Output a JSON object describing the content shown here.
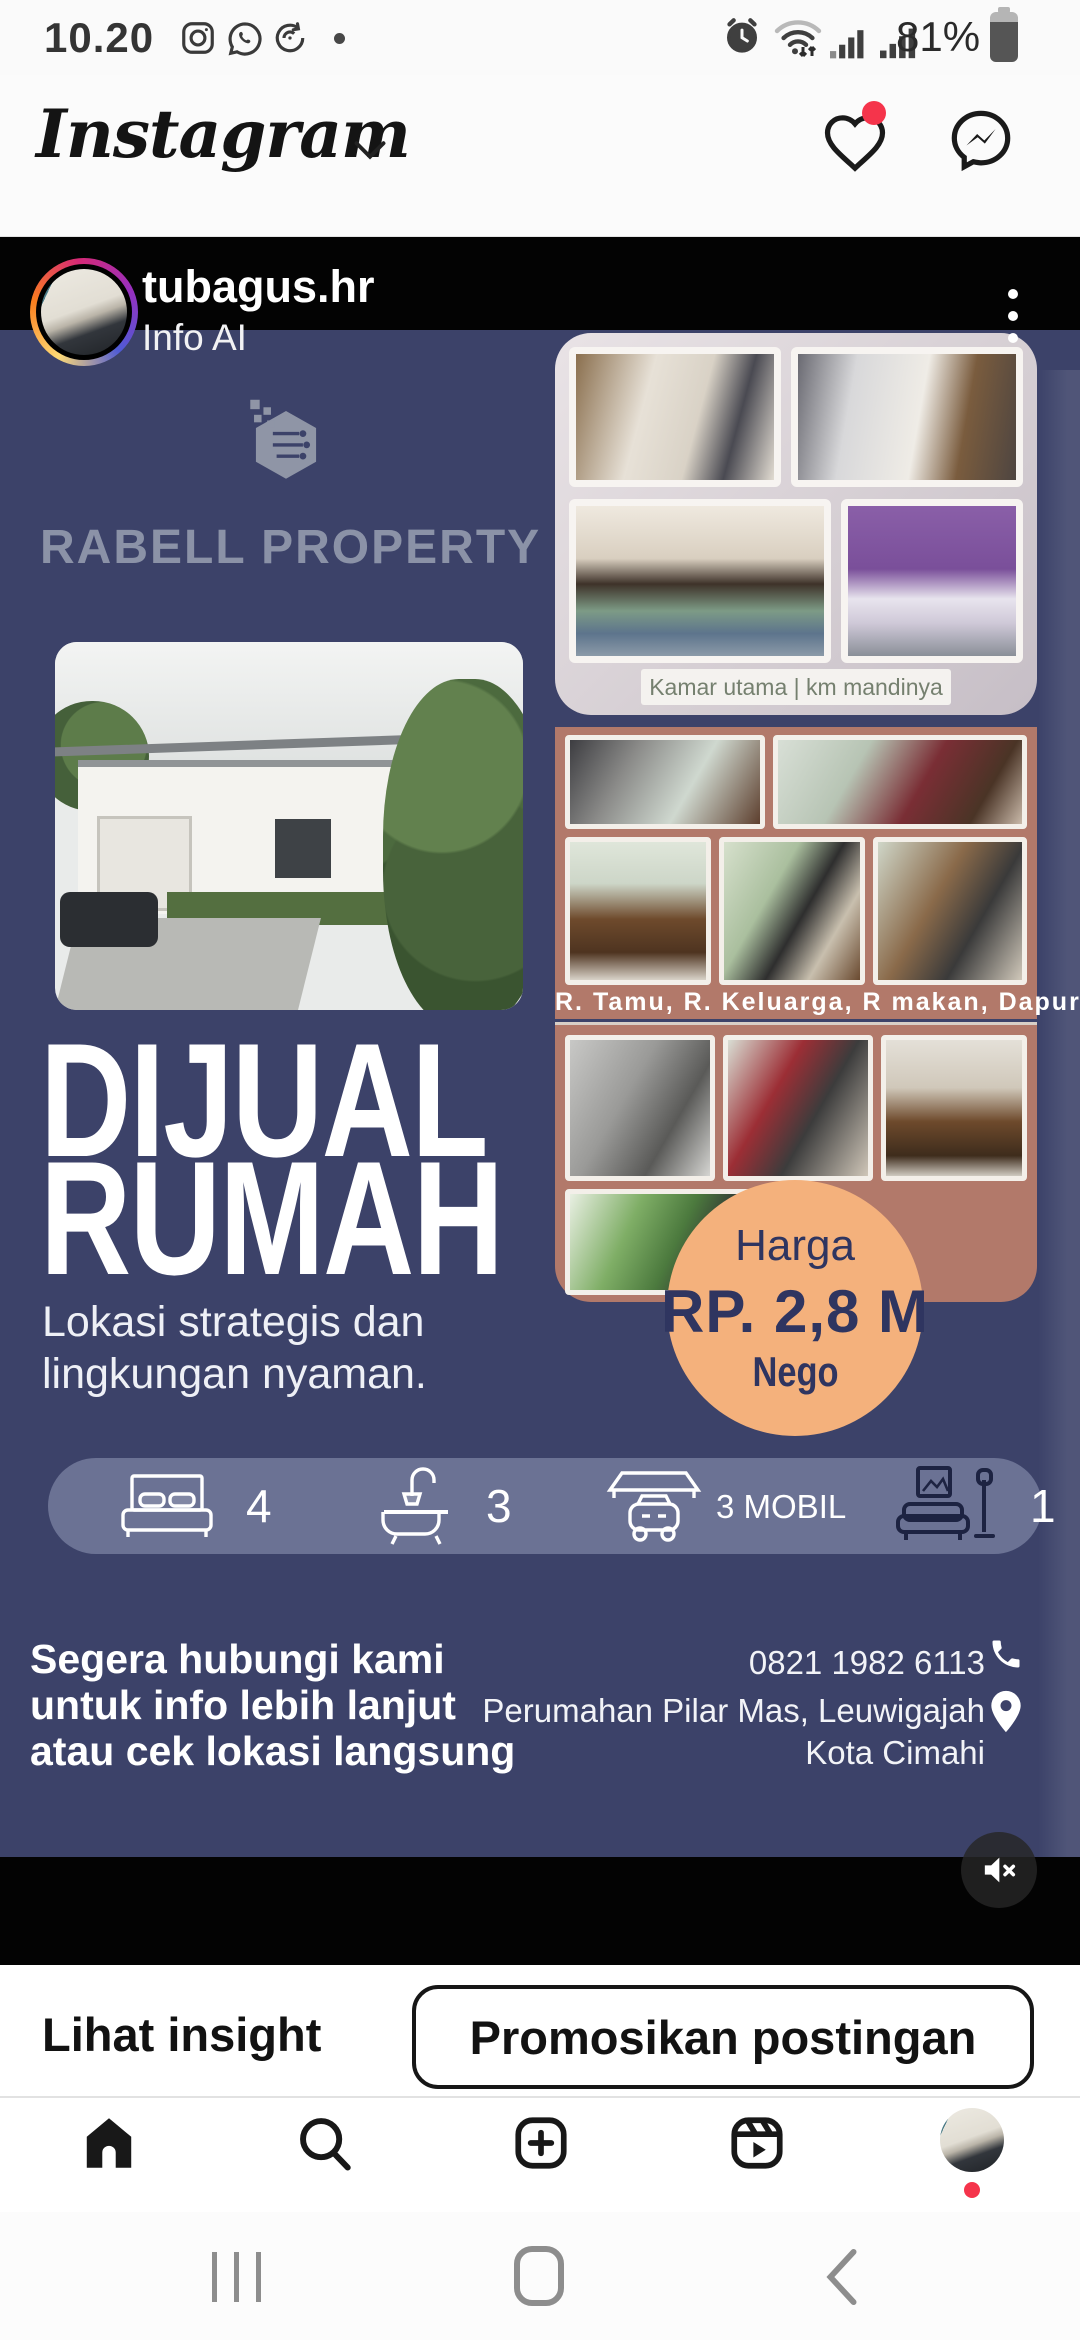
{
  "status_bar": {
    "time": "10.20",
    "battery_percent": "81%",
    "left_icons": [
      "instagram-icon",
      "whatsapp-icon",
      "sync-icon",
      "notification-dot"
    ],
    "right_icons": [
      "alarm-icon",
      "wifi-icon",
      "signal-icon",
      "signal-icon",
      "battery-icon"
    ]
  },
  "app_header": {
    "logo_text": "Instagram",
    "icons": [
      "chevron-down-icon",
      "heart-icon",
      "messenger-icon"
    ]
  },
  "post": {
    "username": "tubagus.hr",
    "info_label": "Info AI",
    "menu_icon": "three-dot-menu-icon",
    "mute_icon": "speaker-muted-icon",
    "flyer": {
      "brand": "RABELL PROPERTY",
      "headline_line1": "DIJUAL",
      "headline_line2": "RUMAH",
      "tagline": "Lokasi strategis dan lingkungan nyaman.",
      "collage_top_caption": "Kamar utama | km mandinya",
      "collage_mid_caption": "R. Tamu, R. Keluarga, R makan, Dapur",
      "price": {
        "label": "Harga",
        "value": "RP. 2,8 M",
        "note": "Nego"
      },
      "amenities": [
        {
          "name": "bedrooms",
          "icon": "bed-icon",
          "count": "4"
        },
        {
          "name": "bathrooms",
          "icon": "bathtub-icon",
          "count": "3"
        },
        {
          "name": "carport",
          "icon": "carport-icon",
          "count": "3 MOBIL"
        },
        {
          "name": "living-room",
          "icon": "sofa-icon",
          "count": "1"
        }
      ],
      "cta_lines": [
        "Segera hubungi kami",
        "untuk info lebih lanjut",
        "atau cek lokasi langsung"
      ],
      "phone": "0821 1982 6113",
      "address_line1": "Perumahan Pilar Mas, Leuwigajah",
      "address_line2": "Kota Cimahi",
      "colors": {
        "navy": "#3c4269",
        "orange": "#f4b17c",
        "terracotta": "#b2796a",
        "accent_red": "#f5344b"
      }
    }
  },
  "actions": {
    "insight_label": "Lihat insight",
    "promote_label": "Promosikan postingan"
  },
  "bottom_nav": {
    "icons": [
      "home-icon",
      "search-icon",
      "create-post-icon",
      "reels-icon",
      "profile-avatar"
    ]
  },
  "android_nav": {
    "icons": [
      "recents-icon",
      "home-pill-icon",
      "back-icon"
    ]
  }
}
